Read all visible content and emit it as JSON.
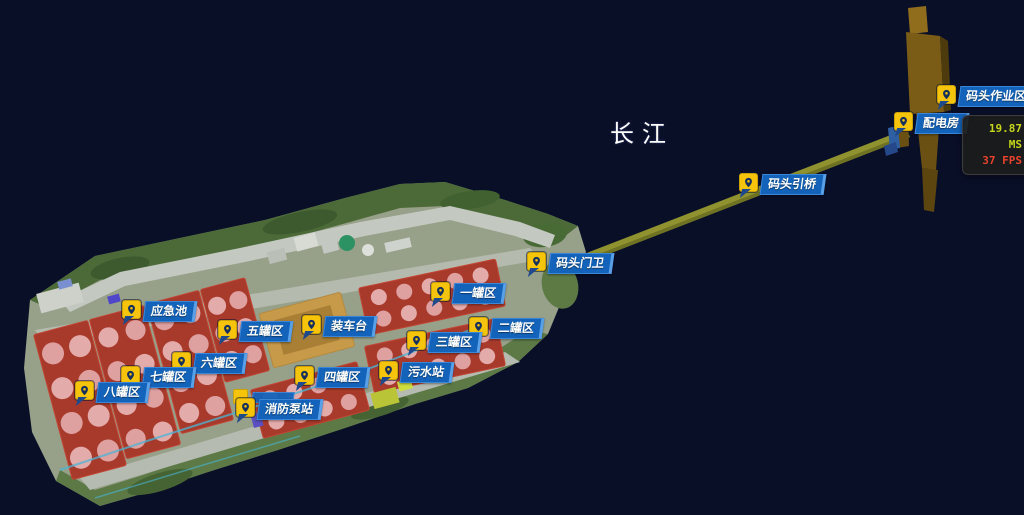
{
  "scene": {
    "river_label": "长江",
    "water_color": "#0a0e26",
    "bridge_color": "#8f922e",
    "pier_color": "#7a5c16"
  },
  "hud": {
    "latency_value": "19.87 MS",
    "fps_value": "37 FPS",
    "latency_color": "#c6d51b",
    "fps_color": "#e8432c"
  },
  "marker_style": {
    "icon_color": "#f6c40a",
    "pin_color": "#16305e",
    "label_bg": "#1463ba",
    "label_text_color": "#ffffff"
  },
  "markers": [
    {
      "id": "emergency-pool",
      "label": "应急池",
      "x": 122,
      "y": 300
    },
    {
      "id": "tank-area-5",
      "label": "五罐区",
      "x": 218,
      "y": 320
    },
    {
      "id": "loading-platform",
      "label": "装车台",
      "x": 302,
      "y": 315
    },
    {
      "id": "tank-area-1",
      "label": "一罐区",
      "x": 431,
      "y": 282
    },
    {
      "id": "tank-area-2",
      "label": "二罐区",
      "x": 469,
      "y": 317
    },
    {
      "id": "tank-area-3",
      "label": "三罐区",
      "x": 407,
      "y": 331
    },
    {
      "id": "tank-area-4",
      "label": "四罐区",
      "x": 295,
      "y": 366
    },
    {
      "id": "sewage-station",
      "label": "污水站",
      "x": 379,
      "y": 361
    },
    {
      "id": "tank-area-6",
      "label": "六罐区",
      "x": 172,
      "y": 352
    },
    {
      "id": "tank-area-7",
      "label": "七罐区",
      "x": 121,
      "y": 366
    },
    {
      "id": "tank-area-8",
      "label": "八罐区",
      "x": 75,
      "y": 381
    },
    {
      "id": "fire-pump-station",
      "label": "消防泵站",
      "x": 236,
      "y": 398
    },
    {
      "id": "dock-gate",
      "label": "码头门卫",
      "x": 527,
      "y": 252
    },
    {
      "id": "dock-bridge",
      "label": "码头引桥",
      "x": 739,
      "y": 173
    },
    {
      "id": "power-distribution-room",
      "label": "配电房",
      "x": 894,
      "y": 112
    },
    {
      "id": "dock-operation-area",
      "label": "码头作业区",
      "x": 937,
      "y": 85
    }
  ]
}
